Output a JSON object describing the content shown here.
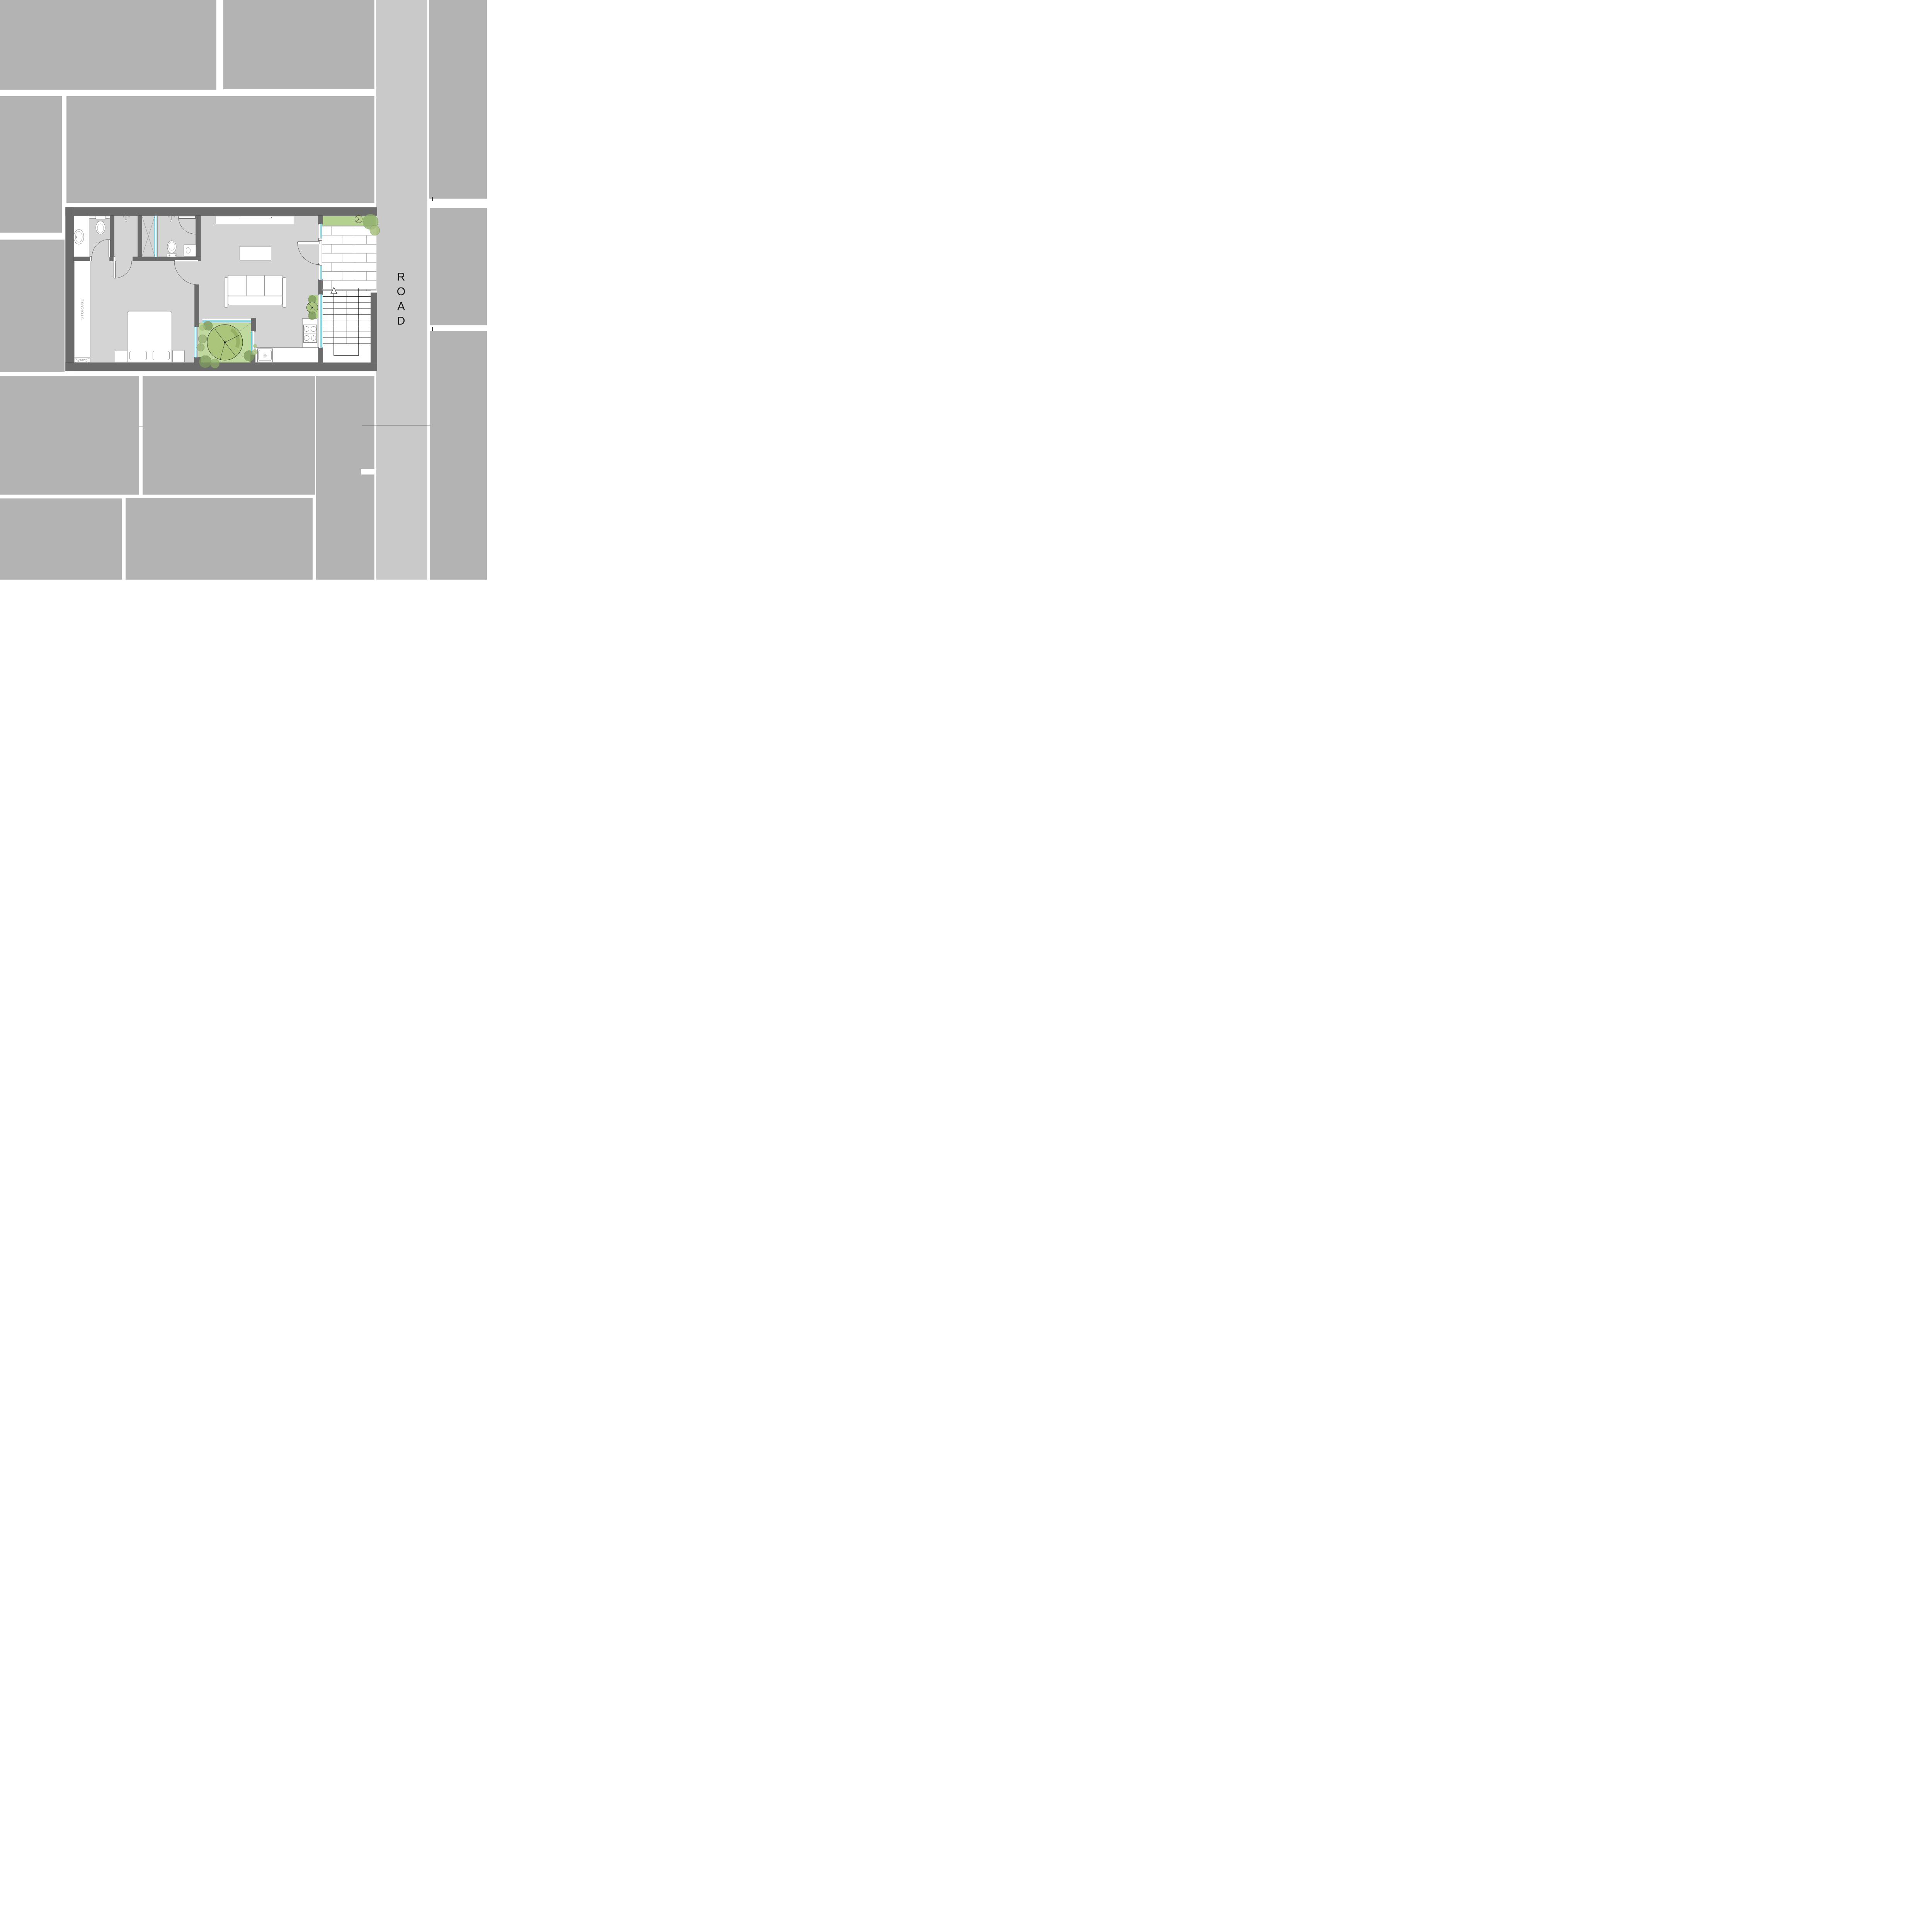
{
  "road": {
    "label": "ROAD",
    "letters": [
      "R",
      "O",
      "A",
      "D"
    ]
  },
  "plan": {
    "storage_label": "STORAGE",
    "ac_shaft_label": "AC SHAFT"
  },
  "colors": {
    "neighbor_block": "#b3b3b3",
    "road_surface": "#c9c9c9",
    "wall": "#6b6b6b",
    "interior_floor": "#d4d4d4",
    "courtyard_green": "#bfd99e",
    "planter_green": "#b5d18f",
    "glass_frame": "#2ec1de",
    "tree_fill": "#a9c478"
  },
  "icons": {
    "toilet": "toilet plan symbol",
    "pedestal_sink": "oval pedestal wash basin",
    "vanity_sink": "square wash basin",
    "shower_head": "wall mounted shower symbol",
    "stove": "4-burner gas hob",
    "kitchen_sink": "single bowl sink with drain",
    "tree": "outlined canopy tree with spokes",
    "bush": "shrub circle",
    "stair_arrow": "stair direction up arrow",
    "ac_shaft": "crossed shaft box"
  }
}
